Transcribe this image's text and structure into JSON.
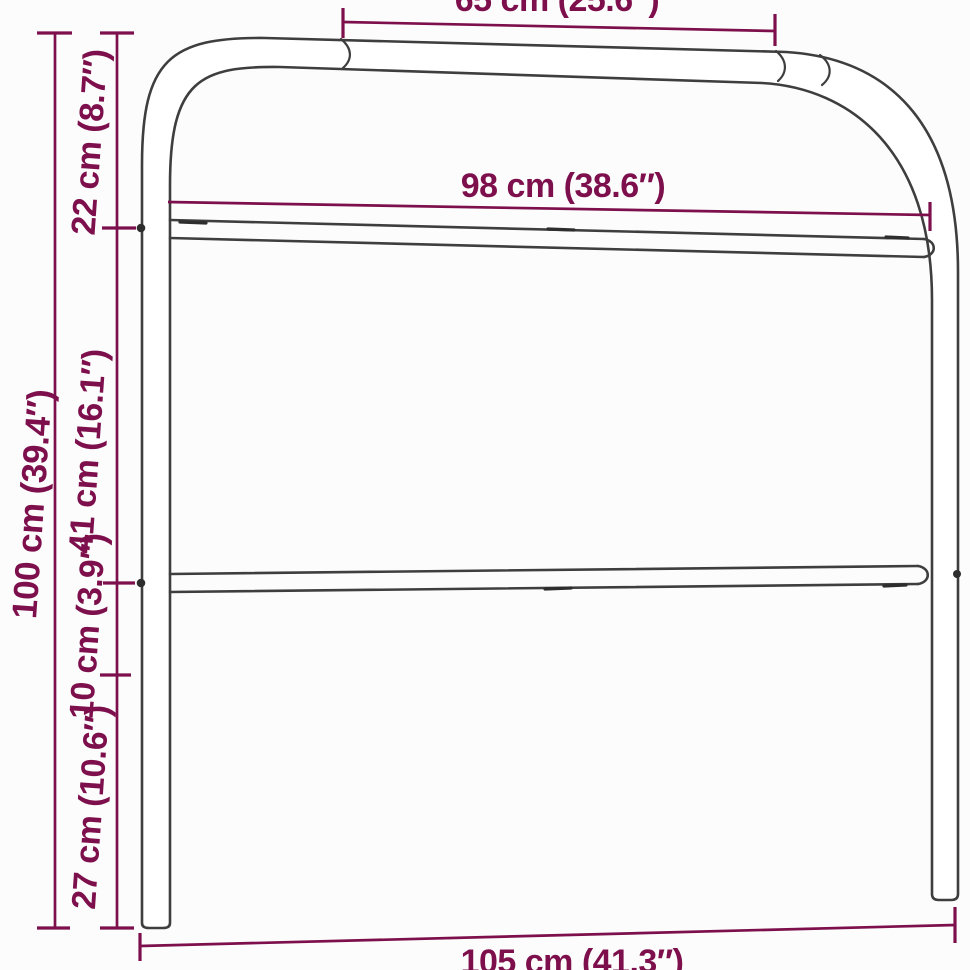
{
  "page": {
    "background": "#fcfcfc"
  },
  "diagram": {
    "subject": "Metal headboard tubular frame dimension drawing",
    "colors": {
      "dimension_accent": "#7d104c",
      "frame_line": "#3e3e3e",
      "frame_fill": "#ffffff"
    },
    "measurements": [
      {
        "id": "top-width",
        "cm": 65,
        "inches": 25.6,
        "label": "65 cm (25.6″)"
      },
      {
        "id": "inner-width",
        "cm": 98,
        "inches": 38.6,
        "label": "98 cm (38.6″)"
      },
      {
        "id": "total-width",
        "cm": 105,
        "inches": 41.3,
        "label": "105 cm (41.3″)"
      },
      {
        "id": "total-height",
        "cm": 100,
        "inches": 39.4,
        "label": "100 cm (39.4″)"
      },
      {
        "id": "top-section-height",
        "cm": 22,
        "inches": 8.7,
        "label": "22 cm (8.7″)"
      },
      {
        "id": "panel-height",
        "cm": 41,
        "inches": 16.1,
        "label": "41 cm (16.1″)"
      },
      {
        "id": "lower-gap-height",
        "cm": 10,
        "inches": 3.9,
        "label": "10 cm (3.9″)"
      },
      {
        "id": "leg-height",
        "cm": 27,
        "inches": 10.6,
        "label": "27 cm (10.6″)"
      }
    ]
  }
}
